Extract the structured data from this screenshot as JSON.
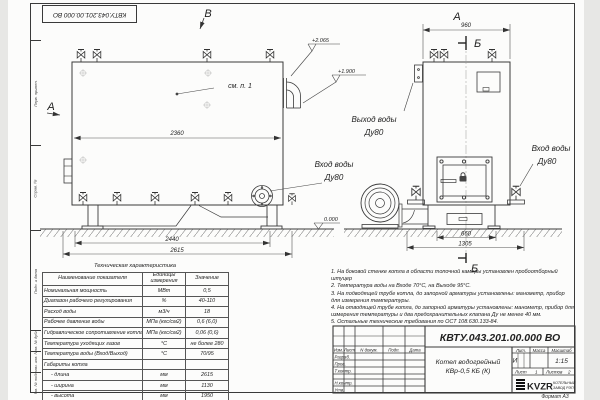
{
  "sheet": {
    "stamp_top": "КВТУ.043.201.00.000 ВО",
    "format_label": "Формат А3"
  },
  "sidebar": {
    "labels": [
      "Перв. примен.",
      "Справ. №",
      "Подп. и дата",
      "Инв. № дубл.",
      "Взам. инв. №",
      "Инв. № подл."
    ]
  },
  "views": {
    "main": {
      "label_top": "В",
      "label_left": "А",
      "see_note": "см. п. 1",
      "dim_width_top": "2360",
      "dim_width_base": "2440",
      "dim_width_total": "2615",
      "elev_1": "+2.065",
      "elev_2": "+1.900",
      "elev_zero": "0.000",
      "inlet_label_line1": "Вход воды",
      "inlet_label_line2": "Ду80"
    },
    "front": {
      "label_top": "А",
      "section_label_top": "Б",
      "section_label_bottom": "Б",
      "dim_width_top": "960",
      "dim_base_inner": "660",
      "dim_base_outer": "1305",
      "outlet_label_line1": "Выход воды",
      "outlet_label_line2": "Ду80",
      "inlet_label_line1": "Вход воды",
      "inlet_label_line2": "Ду80"
    }
  },
  "table": {
    "title": "Техническая характеристика",
    "headers": [
      "Наименование показателя",
      "Единицы измерения",
      "Значение"
    ],
    "rows": [
      [
        "Номинальная мощность",
        "МВт",
        "0,5"
      ],
      [
        "Диапазон рабочего регулирования",
        "%",
        "40-110"
      ],
      [
        "Расход воды",
        "м3/ч",
        "18"
      ],
      [
        "Рабочее давление воды",
        "МПа (кгс/см2)",
        "0,6 (6,0)"
      ],
      [
        "Гидравлическое сопротивление котла",
        "МПа (кгс/см2)",
        "0,06 (0,6)"
      ],
      [
        "Температура уходящих газов",
        "°С",
        "не более 280"
      ],
      [
        "Температура воды (Вход/Выход)",
        "°С",
        "70/95"
      ],
      [
        "Габариты котла",
        "",
        ""
      ],
      [
        "- длина",
        "мм",
        "2615"
      ],
      [
        "- ширина",
        "мм",
        "1130"
      ],
      [
        "- высота",
        "мм",
        "1950"
      ]
    ]
  },
  "notes": [
    "1. На боковой стенке котла в области топочной камеры установлен пробоотборный штуцер",
    "2. Температура воды на Входе 70°С, на Выходе 95°С.",
    "3. На подводящей трубе котла, до запорной арматуры установлены: манометр, прибор для измерения температуры.",
    "4. На отводящей трубе котла, до запорной арматуры установлены: манометр, прибор для измерения температуры и два предохранительных клапана Ду не менее 40 мм.",
    "5. Остальные технические требования по ОСТ 108.630.133-84."
  ],
  "titleblock": {
    "doc_number": "КВТУ.043.201.00.000 ВО",
    "product_line1": "Котел водогрейный",
    "product_line2": "КВр-0,5 КБ (К)",
    "header_row": [
      "Изм.",
      "Лист",
      "N докум.",
      "Подп.",
      "Дата"
    ],
    "row_labels": [
      "Разраб.",
      "Пров.",
      "Т.контр.",
      "Н.контр.",
      "Утв."
    ],
    "lit_header": "Лит.",
    "mass_header": "Масса",
    "scale_header": "Масштаб",
    "lit_value": "И",
    "scale_value": "1:15",
    "sheet_label": "Лист",
    "sheet_value": "1",
    "sheets_label": "Листов",
    "sheets_value": "2",
    "logo_text": "KVZR",
    "logo_sub1": "КОТЕЛЬНЫЙ",
    "logo_sub2": "ЗАВОД РЭП"
  }
}
